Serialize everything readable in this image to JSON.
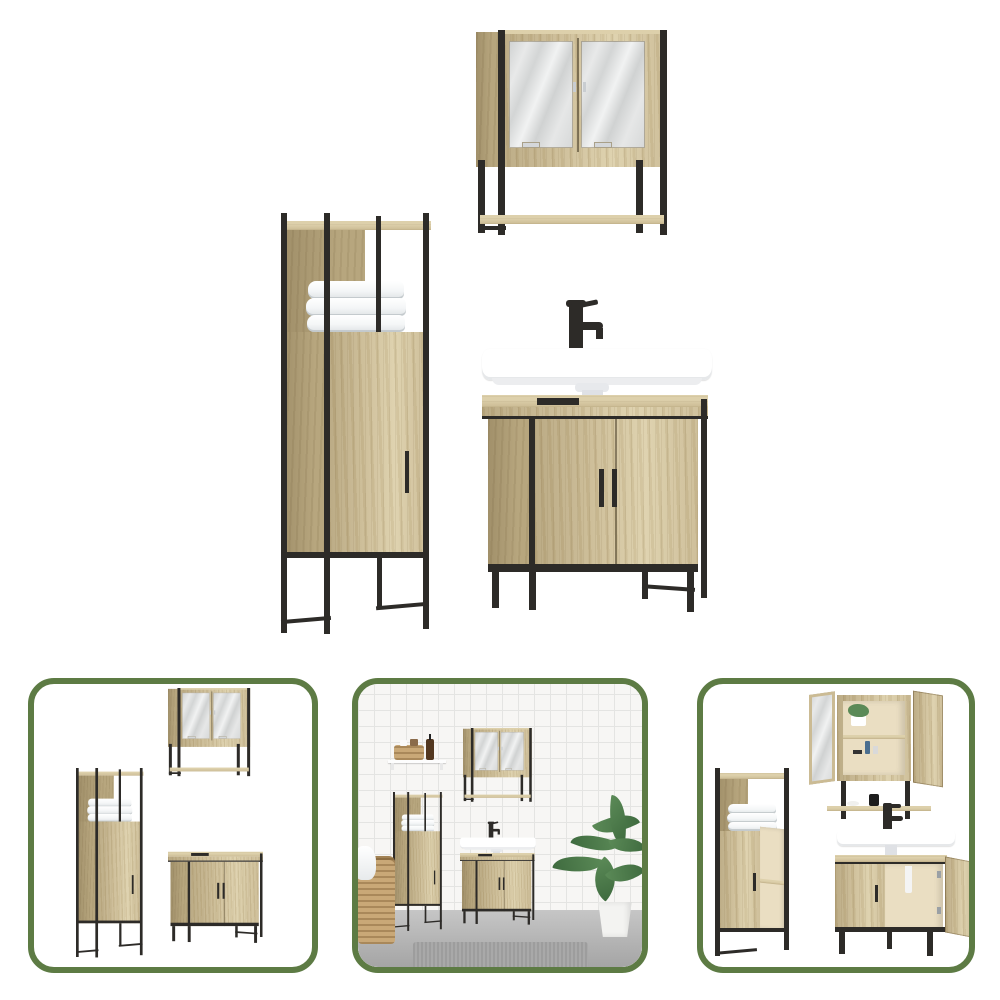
{
  "page": {
    "background": "#ffffff"
  },
  "product_image": {
    "pieces": [
      {
        "id": "mirror-cabinet",
        "parts": [
          "two-mirror-doors",
          "black-steel-frame",
          "towel-rail"
        ]
      },
      {
        "id": "tall-storage-cabinet",
        "parts": [
          "open-top-shelf",
          "folded-towels",
          "single-door",
          "black-steel-frame"
        ]
      },
      {
        "id": "sink-vanity-cabinet",
        "parts": [
          "white-wash-basin",
          "black-faucet",
          "two-doors",
          "black-steel-frame"
        ]
      }
    ]
  },
  "thumbnails": [
    {
      "id": "thumbnail-set-white"
    },
    {
      "id": "thumbnail-bathroom-scene"
    },
    {
      "id": "thumbnail-set-doors-open"
    }
  ],
  "colors": {
    "wood": "#cbbb94",
    "wood_light": "#ddd0ab",
    "wood_side": "#b7a67e",
    "wood_dark": "#a1906a",
    "metal": "#2d2b28",
    "green": "#5d7b44",
    "wall": "#f7f6f4",
    "tile_line": "#e4e4e2",
    "floor": "#c6c6c6",
    "floor_dark": "#a3a3a3",
    "rug": "#a9a9a9",
    "plant": "#5b8a57",
    "plant_dark": "#3f6b3f",
    "pot": "#f3f3f1",
    "wicker": "#c9a877",
    "amber": "#53371f",
    "basin": "#ffffff",
    "pedestal": "#dfe1e5",
    "interior": "#eadec2"
  }
}
